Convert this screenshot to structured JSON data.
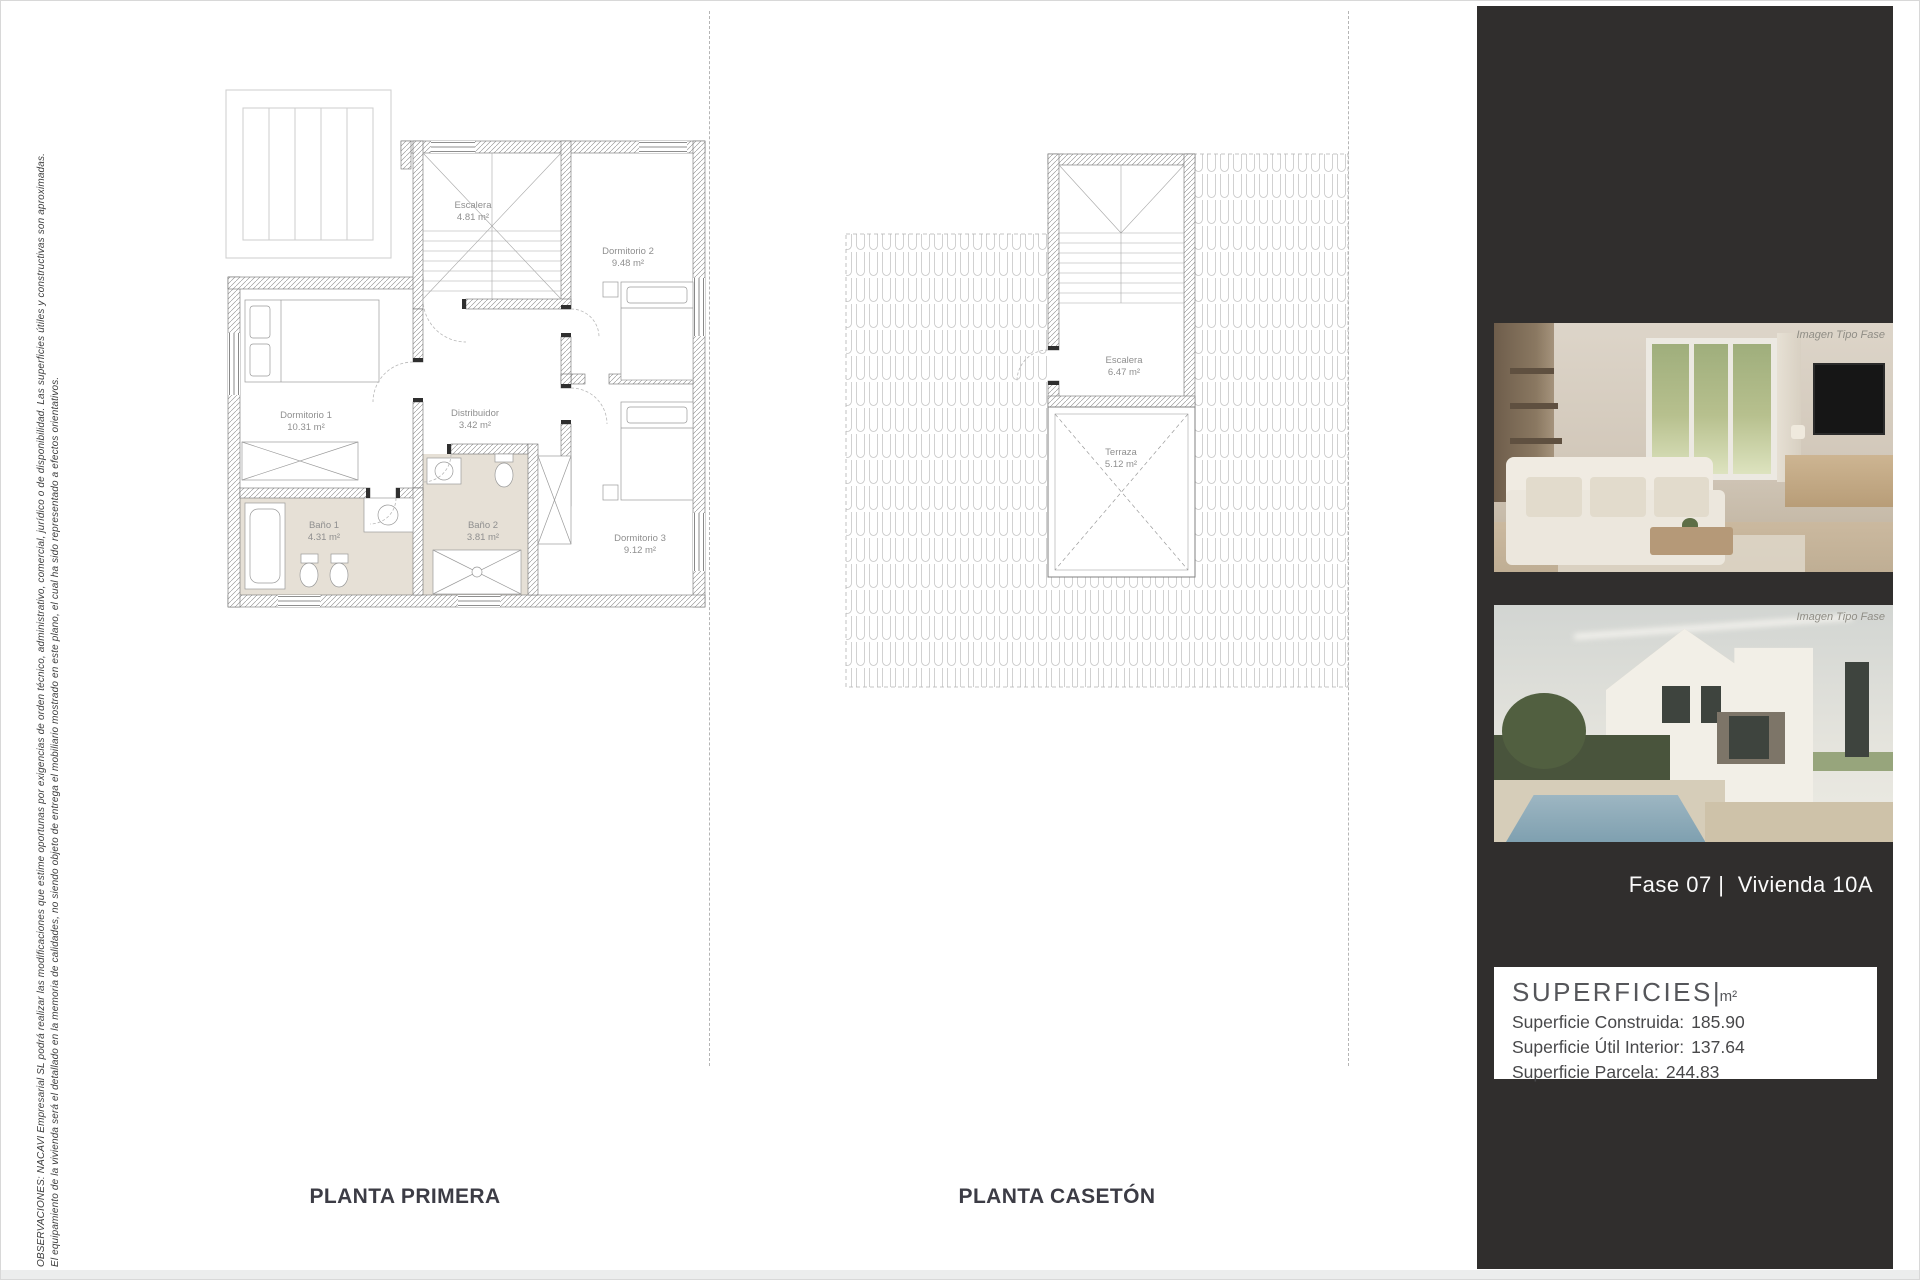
{
  "disclaimer": {
    "line1": "OBSERVACIONES: NACAVI Empresarial SL podrá realizar las modificaciones que estime oportunas por exigencias de orden técnico, administrativo, comercial, jurídico o de disponibilidad. Las superficies útiles y constructivas son aproximadas.",
    "line2": "El equipamiento de la vivienda será el detallado en la memoria de calidades, no siendo objeto de entrega el mobiliario mostrado en este plano, el cual ha sido representado a efectos orientativos."
  },
  "plans": [
    {
      "title": "PLANTA PRIMERA",
      "rooms": [
        {
          "name": "Escalera",
          "area": "4.81 m²"
        },
        {
          "name": "Dormitorio 2",
          "area": "9.48 m²"
        },
        {
          "name": "Dormitorio 1",
          "area": "10.31 m²"
        },
        {
          "name": "Distribuidor",
          "area": "3.42 m²"
        },
        {
          "name": "Baño 1",
          "area": "4.31 m²"
        },
        {
          "name": "Baño 2",
          "area": "3.81 m²"
        },
        {
          "name": "Dormitorio 3",
          "area": "9.12 m²"
        }
      ]
    },
    {
      "title": "PLANTA CASETÓN",
      "rooms": [
        {
          "name": "Escalera",
          "area": "6.47 m²"
        },
        {
          "name": "Terraza",
          "area": "5.12 m²"
        }
      ]
    }
  ],
  "sidebar": {
    "bg_color": "#302e2d",
    "images": [
      {
        "caption": "Imagen Tipo Fase",
        "subject": "living-room interior render"
      },
      {
        "caption": "Imagen Tipo Fase",
        "subject": "house exterior with pool render"
      }
    ],
    "project_label": "Fase 07 |  Vivienda 10A",
    "superficies": {
      "title": "SUPERFICIES",
      "separator": "|",
      "unit": "m²",
      "rows": [
        {
          "label": "Superficie Construida:",
          "value": "185.90"
        },
        {
          "label": "Superficie Útil Interior:",
          "value": "137.64"
        },
        {
          "label": "Superficie Parcela:",
          "value": "244.83"
        }
      ]
    }
  }
}
